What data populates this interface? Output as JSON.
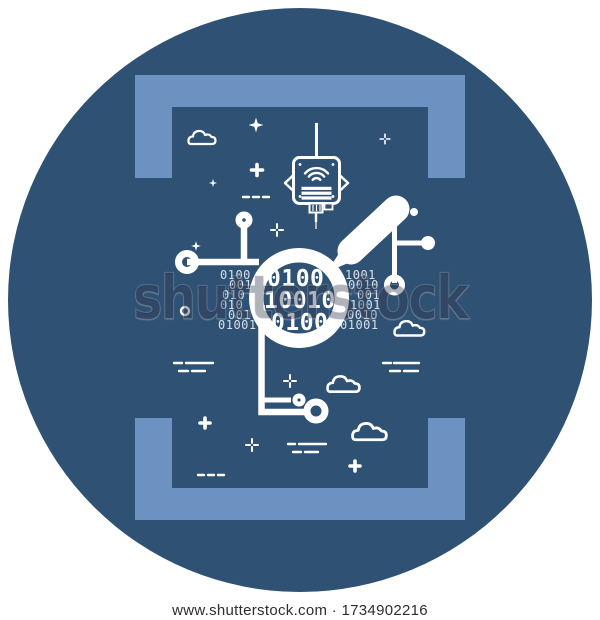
{
  "watermark": {
    "brand": "shutterstock"
  },
  "caption": {
    "site": "www.shutterstock.com",
    "separator": "·",
    "image_id": "1734902216",
    "text": "www.shutterstock.com · 1734902216"
  },
  "colors": {
    "page_background": "#ffffff",
    "circle_background": "#2F5174",
    "bracket_blue": "#6C92C1",
    "line_art": "#ffffff"
  },
  "illustration": {
    "subject": "binary data analysis icon",
    "icons": [
      "magnifier-icon",
      "iot-sensor-icon",
      "wifi-signal-icon",
      "antenna-icon",
      "circuit-node-icon",
      "cloud-icon",
      "sparkle-icon",
      "plus-icon",
      "dash-marks"
    ]
  },
  "binary": {
    "outside_left": [
      {
        "text": "0100",
        "x": 220,
        "y": 268
      },
      {
        "text": "001",
        "x": 229,
        "y": 278
      },
      {
        "text": "010",
        "x": 222,
        "y": 288
      },
      {
        "text": "010",
        "x": 220,
        "y": 298
      },
      {
        "text": "001",
        "x": 228,
        "y": 308
      },
      {
        "text": "01001",
        "x": 218,
        "y": 318
      }
    ],
    "outside_right": [
      {
        "text": "1001",
        "x": 345,
        "y": 268
      },
      {
        "text": "0010",
        "x": 348,
        "y": 278
      },
      {
        "text": "001",
        "x": 357,
        "y": 288
      },
      {
        "text": "1001",
        "x": 350,
        "y": 298
      },
      {
        "text": "0010",
        "x": 347,
        "y": 308
      },
      {
        "text": "01001",
        "x": 340,
        "y": 318
      }
    ],
    "lens": [
      {
        "text": "0100",
        "x": 267,
        "y": 266
      },
      {
        "text": "10010",
        "x": 264,
        "y": 288
      },
      {
        "text": "0100",
        "x": 271,
        "y": 310
      }
    ]
  }
}
